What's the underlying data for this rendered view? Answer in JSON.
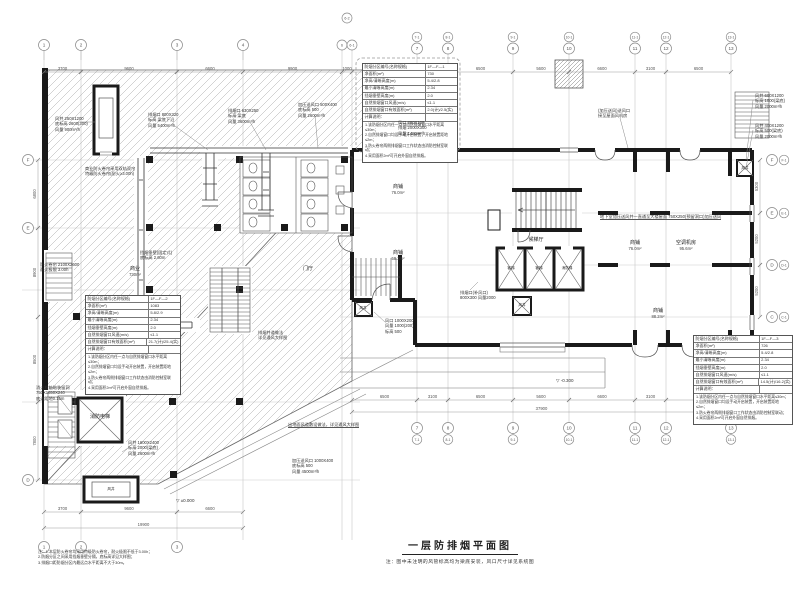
{
  "title": {
    "text": "一层防排烟平面图",
    "note": "注：图中未注明的风管标高均为梁底安装，风口尺寸详见系统图"
  },
  "corner_notes": [
    "注：1.本层防火卷帘均采用特级防火卷帘，耐火极限不低于3.00h；",
    "2.防烟分区之间采用挡烟垂壁分隔，底标高详见大样图；",
    "3.排烟口距防烟分区内最远点水平距离不大于30m。"
  ],
  "colors": {
    "line": "#555555",
    "wall": "#1a1a1a",
    "grid": "#c9c9c9",
    "hatch": "#a8a8a8",
    "dim": "#777777"
  },
  "grid": {
    "top_left": [
      {
        "x": 44,
        "label": "1"
      },
      {
        "x": 81,
        "label": "2"
      },
      {
        "x": 177,
        "label": "3"
      },
      {
        "x": 243,
        "label": "4"
      }
    ],
    "top_twin": [
      {
        "x": 342,
        "label": "6"
      },
      {
        "x": 352,
        "label": "6-1"
      }
    ],
    "top_small": {
      "x": 347,
      "y": 18,
      "label": "6-2"
    },
    "right_cols": [
      {
        "x": 417,
        "num": "7",
        "sub": "7-1"
      },
      {
        "x": 448,
        "num": "8",
        "sub": "8-1"
      },
      {
        "x": 513,
        "num": "9",
        "sub": "9-1"
      },
      {
        "x": 569,
        "num": "10",
        "sub": "10-1"
      },
      {
        "x": 635,
        "num": "11",
        "sub": "11-1"
      },
      {
        "x": 666,
        "num": "12",
        "sub": "12-1"
      },
      {
        "x": 731,
        "num": "13",
        "sub": "13-1"
      }
    ],
    "bottom_left": [
      {
        "x": 44,
        "label": "1"
      },
      {
        "x": 81,
        "label": "2"
      },
      {
        "x": 177,
        "label": "3"
      }
    ],
    "left_rows": [
      {
        "y": 160,
        "label": "F"
      },
      {
        "y": 228,
        "label": "E"
      },
      {
        "y": 480,
        "label": "D"
      }
    ],
    "right_rows": [
      {
        "y": 160,
        "a": "F",
        "b": "F-1"
      },
      {
        "y": 213,
        "a": "E",
        "b": "E-1"
      },
      {
        "y": 265,
        "a": "D",
        "b": "D-1"
      },
      {
        "y": 317,
        "a": "C",
        "b": "C-1"
      }
    ]
  },
  "dimensions": [
    {
      "dir": "h",
      "y": 72,
      "segs": [
        [
          44,
          81,
          "3700"
        ],
        [
          81,
          177,
          "9600"
        ],
        [
          177,
          243,
          "6600"
        ],
        [
          243,
          342,
          "9900"
        ],
        [
          342,
          352,
          "1000"
        ]
      ]
    },
    {
      "dir": "h",
      "y": 72,
      "segs": [
        [
          352,
          417,
          "6500"
        ],
        [
          417,
          448,
          "3100"
        ],
        [
          448,
          513,
          "6500"
        ],
        [
          513,
          569,
          "5600"
        ],
        [
          569,
          635,
          "6600"
        ],
        [
          635,
          666,
          "3100"
        ],
        [
          666,
          731,
          "6500"
        ]
      ]
    },
    {
      "dir": "h",
      "y": 400,
      "segs": [
        [
          352,
          417,
          "6500"
        ],
        [
          417,
          448,
          "3100"
        ],
        [
          448,
          513,
          "6500"
        ],
        [
          513,
          569,
          "5600"
        ],
        [
          569,
          635,
          "6600"
        ],
        [
          635,
          666,
          "3100"
        ],
        [
          666,
          731,
          "6500"
        ]
      ]
    },
    {
      "dir": "h",
      "y": 412,
      "segs": [
        [
          352,
          731,
          "37900"
        ]
      ]
    },
    {
      "dir": "h",
      "y": 512,
      "segs": [
        [
          44,
          81,
          "3700"
        ],
        [
          81,
          177,
          "9600"
        ],
        [
          177,
          243,
          "6600"
        ]
      ]
    },
    {
      "dir": "h",
      "y": 528,
      "segs": [
        [
          44,
          243,
          "19900"
        ]
      ]
    },
    {
      "dir": "v",
      "x": 38,
      "segs": [
        [
          160,
          228,
          "6800"
        ],
        [
          228,
          317,
          "8900"
        ],
        [
          317,
          402,
          "8500"
        ],
        [
          402,
          480,
          "7800"
        ]
      ]
    },
    {
      "dir": "v",
      "x": 760,
      "segs": [
        [
          160,
          213,
          "5300"
        ],
        [
          213,
          265,
          "5200"
        ],
        [
          265,
          317,
          "5200"
        ]
      ]
    }
  ],
  "tables": [
    {
      "x": 362,
      "y": 63,
      "w": 94,
      "rows": [
        [
          "防烟分区编号(名称规格)",
          "1F—F—1"
        ],
        [
          "净面积(m²)",
          "730"
        ],
        [
          "净高/清晰高度(m)",
          "5.4/2.8"
        ],
        [
          "最小清晰高度(m)",
          "2.34"
        ],
        [
          "挡烟垂壁高度(m)",
          "2.0"
        ],
        [
          "自然排烟窗口风速(m/s)",
          "≤1.1"
        ],
        [
          "自然排烟窗口有效面积(m²)",
          "2.0(计)/2.5(实)"
        ],
        [
          "计算说明：",
          ""
        ]
      ],
      "notes": [
        "1.该防烟分区内任一点与自然排烟窗口水平距离≤30m；",
        "2.自然排烟窗口均设手动开启装置，开启装置距地≤2m；",
        "3.防火卷帘两侧排烟窗口工作状态由消防控制室联动；",
        "4.采用面积2m²可开启外窗自然排烟。"
      ]
    },
    {
      "x": 85,
      "y": 295,
      "w": 94,
      "rows": [
        [
          "防烟分区编号(名称规格)",
          "1F—F—2"
        ],
        [
          "净面积(m²)",
          "1083"
        ],
        [
          "净高/清晰高度(m)",
          "5.8/2.9"
        ],
        [
          "最小清晰高度(m)",
          "2.34"
        ],
        [
          "挡烟垂壁高度(m)",
          "2.0"
        ],
        [
          "自然排烟窗口风速(m/s)",
          "≤1.1"
        ],
        [
          "自然排烟窗口有效面积(m²)",
          "21.7(计)/25.4(实)"
        ],
        [
          "计算说明：",
          ""
        ]
      ],
      "notes": [
        "1.该防烟分区内任一点与自然排烟窗口水平距离≤30m；",
        "2.自然排烟窗口均设手动开启装置，开启装置距地≤2m；",
        "3.防火卷帘两侧排烟窗口工作状态由消防控制室联动；",
        "4.采用面积2m²可开启外窗自然排烟。"
      ]
    },
    {
      "x": 693,
      "y": 335,
      "w": 98,
      "rows": [
        [
          "防烟分区编号(名称规格)",
          "1F—F—3"
        ],
        [
          "净面积(m²)",
          "726"
        ],
        [
          "净高/清晰高度(m)",
          "5.4/2.8"
        ],
        [
          "最小清晰高度(m)",
          "2.34"
        ],
        [
          "挡烟垂壁高度(m)",
          "2.0"
        ],
        [
          "自然排烟窗口风速(m/s)",
          "≤1.1"
        ],
        [
          "自然排烟窗口有效面积(m²)",
          "14.5(计)/16.2(实)"
        ],
        [
          "计算说明：",
          ""
        ]
      ],
      "notes": [
        "1.该防烟分区内任一点与自然排烟窗口水平距离≤30m；",
        "2.自然排烟窗口均设手动开启装置，开启装置距地≤2m；",
        "3.防火卷帘两侧排烟窗口工作状态由消防控制室联动；",
        "4.采用面积2m²可开启外窗自然排烟。"
      ]
    }
  ],
  "annotations": [
    {
      "x": 55,
      "y": 116,
      "lines": [
        "风井 250X1200",
        "底标高 2600(300)",
        "风量 900m³/h"
      ],
      "leader": [
        80,
        122,
        96,
        122
      ]
    },
    {
      "x": 148,
      "y": 112,
      "lines": [
        "排烟口 800X320",
        "标高 梁底下沿",
        "风量 5400m³/h"
      ],
      "leader": [
        175,
        126,
        208,
        150
      ]
    },
    {
      "x": 228,
      "y": 108,
      "lines": [
        "排烟口 630X250",
        "标高 梁底",
        "风量 3600m³/h"
      ],
      "leader": [
        250,
        122,
        266,
        150
      ]
    },
    {
      "x": 298,
      "y": 102,
      "lines": [
        "加压送风口 500X400",
        "底标高 500",
        "风量 2600m³/h"
      ],
      "leader": [
        315,
        116,
        318,
        148
      ]
    },
    {
      "x": 398,
      "y": 120,
      "lines": [
        "风口 800X100",
        "排烟 2000X300",
        "风量 1450m³/h"
      ],
      "leader": [
        420,
        134,
        430,
        150
      ]
    },
    {
      "x": 598,
      "y": 108,
      "lines": [
        "(加压送风)送风口",
        "接至屋面风机房"
      ],
      "leader": [
        620,
        118,
        628,
        148
      ]
    },
    {
      "x": 600,
      "y": 214,
      "lines": [
        "地下室加压送风井一直通至大楼屋面 750X250(预留洞口)加压送风"
      ],
      "ul": true
    },
    {
      "x": 755,
      "y": 93,
      "lines": [
        "风井 600X1200",
        "标高 1000(梁底)",
        "风量 2000m³/h"
      ],
      "leader": [
        753,
        100,
        746,
        160
      ]
    },
    {
      "x": 755,
      "y": 123,
      "lines": [
        "风井 400X1200",
        "标高 500(梁底)",
        "风量 2000m³/h"
      ],
      "leader": [
        753,
        130,
        746,
        168
      ]
    },
    {
      "x": 258,
      "y": 330,
      "lines": [
        "排烟井道做法",
        "详见通风大样图"
      ]
    },
    {
      "x": 288,
      "y": 422,
      "lines": [
        "出地面风道敷设做法，详见通风大样图"
      ],
      "ul": true
    },
    {
      "x": 128,
      "y": 440,
      "lines": [
        "风井 1600X2400",
        "标高 2000(梁底)",
        "风量 2600m³/h"
      ],
      "leader": [
        128,
        448,
        122,
        452
      ]
    },
    {
      "x": 292,
      "y": 458,
      "lines": [
        "加压送风口 1000X400",
        "底标高 500",
        "风量 4500m³/h"
      ]
    },
    {
      "x": 85,
      "y": 166,
      "lines": [
        "商业防火卷帘采用双轨双帘",
        "特级防火卷帘(耐火≥3.00h)"
      ]
    },
    {
      "x": 140,
      "y": 250,
      "lines": [
        "挡烟垂壁(固定式)",
        "底标高 2.60m"
      ]
    },
    {
      "x": 40,
      "y": 262,
      "lines": [
        "防火卷帘 2100X2600",
        "耐火极限 3.00h"
      ]
    },
    {
      "x": 36,
      "y": 385,
      "lines": [
        "消火栓箱暗装留洞",
        "750X1650X240",
        "底边距地0.15m"
      ]
    },
    {
      "x": 385,
      "y": 318,
      "lines": [
        "风口 1000X200",
        "风量 1000(200)",
        "标高 500"
      ],
      "leader": [
        385,
        322,
        374,
        312
      ]
    },
    {
      "x": 460,
      "y": 290,
      "lines": [
        "排烟口(补风口)",
        "800X300 风量2000"
      ],
      "leader": [
        470,
        290,
        478,
        282
      ]
    }
  ],
  "rooms": [
    {
      "x": 135,
      "y": 266,
      "name": "商业",
      "area": "730m²"
    },
    {
      "x": 308,
      "y": 266,
      "name": "门厅",
      "area": ""
    },
    {
      "x": 398,
      "y": 184,
      "name": "商铺",
      "area": "76.0m²"
    },
    {
      "x": 398,
      "y": 250,
      "name": "商铺",
      "area": "58.3m²"
    },
    {
      "x": 536,
      "y": 237,
      "name": "候梯厅",
      "area": ""
    },
    {
      "x": 635,
      "y": 240,
      "name": "商铺",
      "area": "76.0m²"
    },
    {
      "x": 686,
      "y": 240,
      "name": "空调机房",
      "area": "95.6m²"
    },
    {
      "x": 658,
      "y": 308,
      "name": "商铺",
      "area": "88.2m²"
    },
    {
      "x": 100,
      "y": 414,
      "name": "消防电梯",
      "area": ""
    }
  ],
  "lift_labels": [
    {
      "x": 511,
      "y": 266,
      "t": "客梯"
    },
    {
      "x": 539,
      "y": 266,
      "t": "客梯"
    },
    {
      "x": 567,
      "y": 266,
      "t": "消防梯"
    },
    {
      "x": 111,
      "y": 487,
      "t": "风井"
    },
    {
      "x": 363,
      "y": 306,
      "t": "风井"
    },
    {
      "x": 522,
      "y": 303,
      "t": "风井"
    },
    {
      "x": 745,
      "y": 166,
      "t": "风井"
    }
  ],
  "elevations": [
    {
      "x": 176,
      "y": 498,
      "t": "▽ ±0.000"
    },
    {
      "x": 556,
      "y": 378,
      "t": "▽ -0.300"
    }
  ]
}
